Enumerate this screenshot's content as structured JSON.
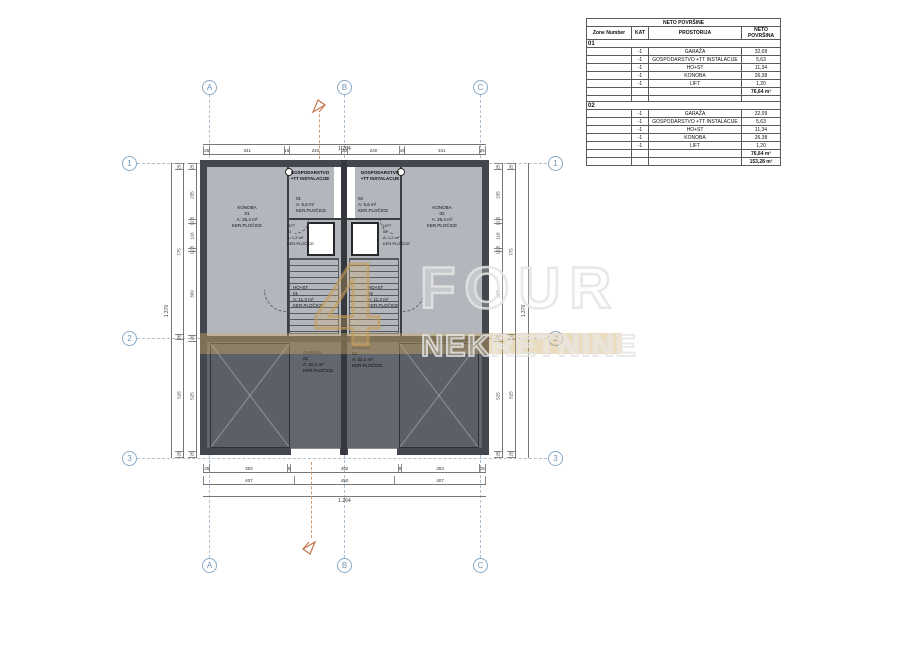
{
  "grid": {
    "cols": [
      "A",
      "B",
      "C"
    ],
    "rows": [
      "1",
      "2",
      "3"
    ]
  },
  "table": {
    "title": "NETO POVRŠINE",
    "columns": [
      "Zone Number",
      "KAT",
      "PROSTORIJA",
      "NETO POVRŠINA"
    ],
    "sections": [
      {
        "zone": "01",
        "rows": [
          {
            "kat": "-1",
            "room": "GARAŽA",
            "area": "32,09"
          },
          {
            "kat": "-1",
            "room": "GOSPODARSTVO +TT INSTALACIJE",
            "area": "5,63"
          },
          {
            "kat": "-1",
            "room": "HO+ST",
            "area": "11,34"
          },
          {
            "kat": "-1",
            "room": "KONOBA",
            "area": "26,38"
          },
          {
            "kat": "-1",
            "room": "LIFT",
            "area": "1,20"
          }
        ],
        "total": "76,64 m²"
      },
      {
        "zone": "02",
        "rows": [
          {
            "kat": "-1",
            "room": "GARAŽA",
            "area": "32,09"
          },
          {
            "kat": "-1",
            "room": "GOSPODARSTVO +TT INSTALACIJE",
            "area": "5,63"
          },
          {
            "kat": "-1",
            "room": "HO+ST",
            "area": "11,34"
          },
          {
            "kat": "-1",
            "room": "KONOBA",
            "area": "26,38"
          },
          {
            "kat": "-1",
            "room": "LIFT",
            "area": "1,20"
          }
        ],
        "total": "76,64 m²"
      }
    ],
    "grand_total": "153,28 m²"
  },
  "dimensions": {
    "top_total": "1.264",
    "top_chain": [
      "25",
      "341",
      "16",
      "240",
      "20",
      "240",
      "16",
      "341",
      "25"
    ],
    "bottom_chain": [
      "25",
      "353",
      "8",
      "492",
      "8",
      "353",
      "25"
    ],
    "bottom_mid": [
      "407",
      "450",
      "407"
    ],
    "bottom_total": "1.264",
    "side_total": "1.370",
    "side_outer": [
      "25",
      "775",
      "20",
      "525",
      "25"
    ],
    "side_chain": [
      "25",
      "235",
      "12,5",
      "116",
      "12,5",
      "399",
      "20",
      "525",
      "25"
    ]
  },
  "rooms": {
    "gospodarstvo_left": {
      "title": [
        "GOSPODARSTVO",
        "+TT INSTALACIJE"
      ],
      "info": [
        "01",
        "A: 5,6 m²",
        "KER.PLOČICE"
      ]
    },
    "gospodarstvo_right": {
      "title": [
        "GOSPODARSTVO",
        "+TT INSTALACIJE"
      ],
      "info": [
        "02",
        "A: 5,6 m²",
        "KER.PLOČICE"
      ]
    },
    "lift_left": {
      "lines": [
        "LIFT",
        "01",
        "A: 1,2 m²",
        "KER.PLOČICE"
      ]
    },
    "lift_right": {
      "lines": [
        "LIFT",
        "02",
        "A: 1,2 m²",
        "KER.PLOČICE"
      ]
    },
    "konoba_left": {
      "lines": [
        "KONOBA",
        "01",
        "A: 26,4 m²",
        "KER.PLOČICE"
      ]
    },
    "konoba_right": {
      "lines": [
        "KONOBA",
        "02",
        "A: 26,4 m²",
        "KER.PLOČICE"
      ]
    },
    "host_left": {
      "lines": [
        "HO+ST",
        "01",
        "A: 11,3 m²",
        "KER.PLOČICE"
      ]
    },
    "host_right": {
      "lines": [
        "HO+ST",
        "02",
        "A: 11,3 m²",
        "KER.PLOČICE"
      ]
    },
    "garaza_left": {
      "lines": [
        "GARAŽA",
        "01",
        "A: 32,1 m²",
        "KER.PLOČICE"
      ]
    },
    "garaza_right": {
      "lines": [
        "GARAŽA",
        "02",
        "A: 32,1 m²",
        "KER.PLOČICE"
      ]
    }
  },
  "watermark": {
    "digit": "4",
    "line1": "FOUR",
    "line2": "NEKRETNINE"
  },
  "colors": {
    "wall": "#44474d",
    "floor_upper": "#b3b7bd",
    "floor_garage": "#63666c",
    "grid_blue": "#88aac6",
    "dimension": "#777777",
    "section_orange": "#c4744a",
    "watermark_gold": "#cfab69"
  }
}
